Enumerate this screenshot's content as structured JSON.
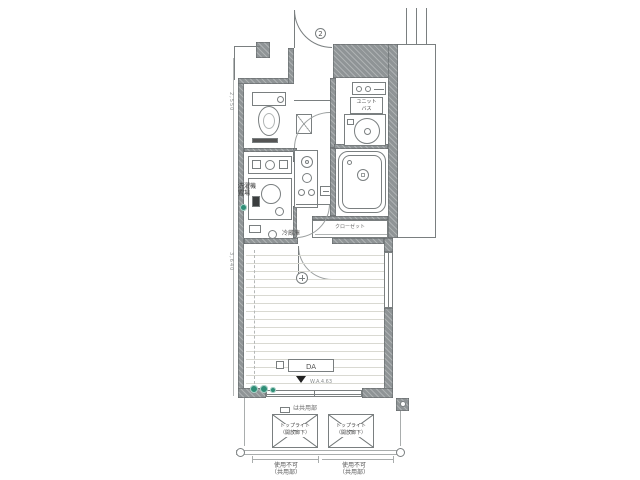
{
  "plan": {
    "entrance_badge": "2",
    "legend": {
      "note": "は共用部"
    },
    "rooms": {
      "unit_bath_label": {
        "line1": "ユニット",
        "line2": "バス"
      },
      "laundry_label": {
        "line1": "洗濯機",
        "line2": "置場"
      },
      "closet_label": "クローゼット",
      "fridge_label": "冷蔵庫",
      "da_label": "DA"
    },
    "annotations": {
      "window_note": "W.A.4.63",
      "dim_left_upper": "2,550",
      "dim_left_lower": "3,640"
    },
    "balcony": {
      "hatch_boxes": [
        {
          "line1": "トップライト",
          "line2": "（開放廊下）"
        },
        {
          "line1": "トップライト",
          "line2": "（開放廊下）"
        }
      ],
      "captions": [
        {
          "line1": "使用不可",
          "line2": "（共用部）"
        },
        {
          "line1": "使用不可",
          "line2": "（共用部）"
        }
      ]
    },
    "colors": {
      "wall": "#8f9496",
      "line": "#7a7f80",
      "floor_line": "#d9d9d2",
      "green": "#2f8e77",
      "paper": "#ffffff"
    }
  }
}
